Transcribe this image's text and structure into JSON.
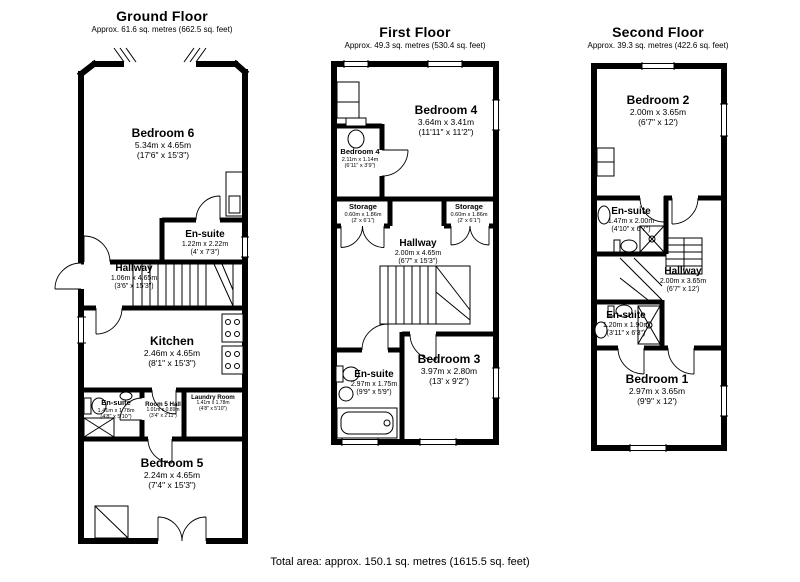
{
  "page": {
    "background": "#ffffff",
    "wall_color": "#000000"
  },
  "floors": [
    {
      "title": "Ground Floor",
      "subtitle": "Approx. 61.6 sq. metres (662.5 sq. feet)",
      "rooms": [
        {
          "name": "Bedroom 6",
          "dims_m": "5.34m x 4.65m",
          "dims_ft": "(17'6\" x 15'3\")"
        },
        {
          "name": "En-suite",
          "dims_m": "1.22m x 2.22m",
          "dims_ft": "(4' x 7'3\")"
        },
        {
          "name": "Hallway",
          "dims_m": "1.06m x 4.65m",
          "dims_ft": "(3'6\" x 15'3\")"
        },
        {
          "name": "Kitchen",
          "dims_m": "2.46m x 4.65m",
          "dims_ft": "(8'1\" x 15'3\")"
        },
        {
          "name": "En-suite",
          "dims_m": "1.41m x 1.78m",
          "dims_ft": "(4'8\" x 5'10\")"
        },
        {
          "name": "Room 5 Hall",
          "dims_m": "1.01m x 0.89m",
          "dims_ft": "(3'4\" x 2'11\")"
        },
        {
          "name": "Laundry Room",
          "dims_m": "1.41m x 1.78m",
          "dims_ft": "(4'8\" x 5'10\")"
        },
        {
          "name": "Bedroom 5",
          "dims_m": "2.24m x 4.65m",
          "dims_ft": "(7'4\" x 15'3\")"
        }
      ]
    },
    {
      "title": "First Floor",
      "subtitle": "Approx. 49.3 sq. metres (530.4 sq. feet)",
      "rooms": [
        {
          "name": "Bedroom 4",
          "dims_m": "3.64m x 3.41m",
          "dims_ft": "(11'11\" x 11'2\")"
        },
        {
          "name": "Bedroom 4",
          "dims_m": "2.11m x 1.14m",
          "dims_ft": "(6'11\" x 3'9\")"
        },
        {
          "name": "Storage",
          "dims_m": "0.60m x 1.86m",
          "dims_ft": "(2' x 6'1\")"
        },
        {
          "name": "Storage",
          "dims_m": "0.60m x 1.86m",
          "dims_ft": "(2' x 6'1\")"
        },
        {
          "name": "Hallway",
          "dims_m": "2.00m x 4.65m",
          "dims_ft": "(6'7\" x 15'3\")"
        },
        {
          "name": "En-suite",
          "dims_m": "2.97m x 1.75m",
          "dims_ft": "(9'9\" x 5'9\")"
        },
        {
          "name": "Bedroom 3",
          "dims_m": "3.97m x 2.80m",
          "dims_ft": "(13' x 9'2\")"
        }
      ]
    },
    {
      "title": "Second Floor",
      "subtitle": "Approx. 39.3 sq. metres (422.6 sq. feet)",
      "rooms": [
        {
          "name": "Bedroom 2",
          "dims_m": "2.00m x 3.65m",
          "dims_ft": "(6'7\" x 12')"
        },
        {
          "name": "En-suite",
          "dims_m": "1.47m x 2.00m",
          "dims_ft": "(4'10\" x 6'7\")"
        },
        {
          "name": "Hallway",
          "dims_m": "2.00m x 3.65m",
          "dims_ft": "(6'7\" x 12')"
        },
        {
          "name": "En-suite",
          "dims_m": "1.20m x 1.90m",
          "dims_ft": "(3'11\" x 6'3\")"
        },
        {
          "name": "Bedroom 1",
          "dims_m": "2.97m x 3.65m",
          "dims_ft": "(9'9\" x 12')"
        }
      ]
    }
  ],
  "footer": {
    "total_area": "Total area: approx. 150.1 sq. metres (1615.5 sq. feet)"
  }
}
